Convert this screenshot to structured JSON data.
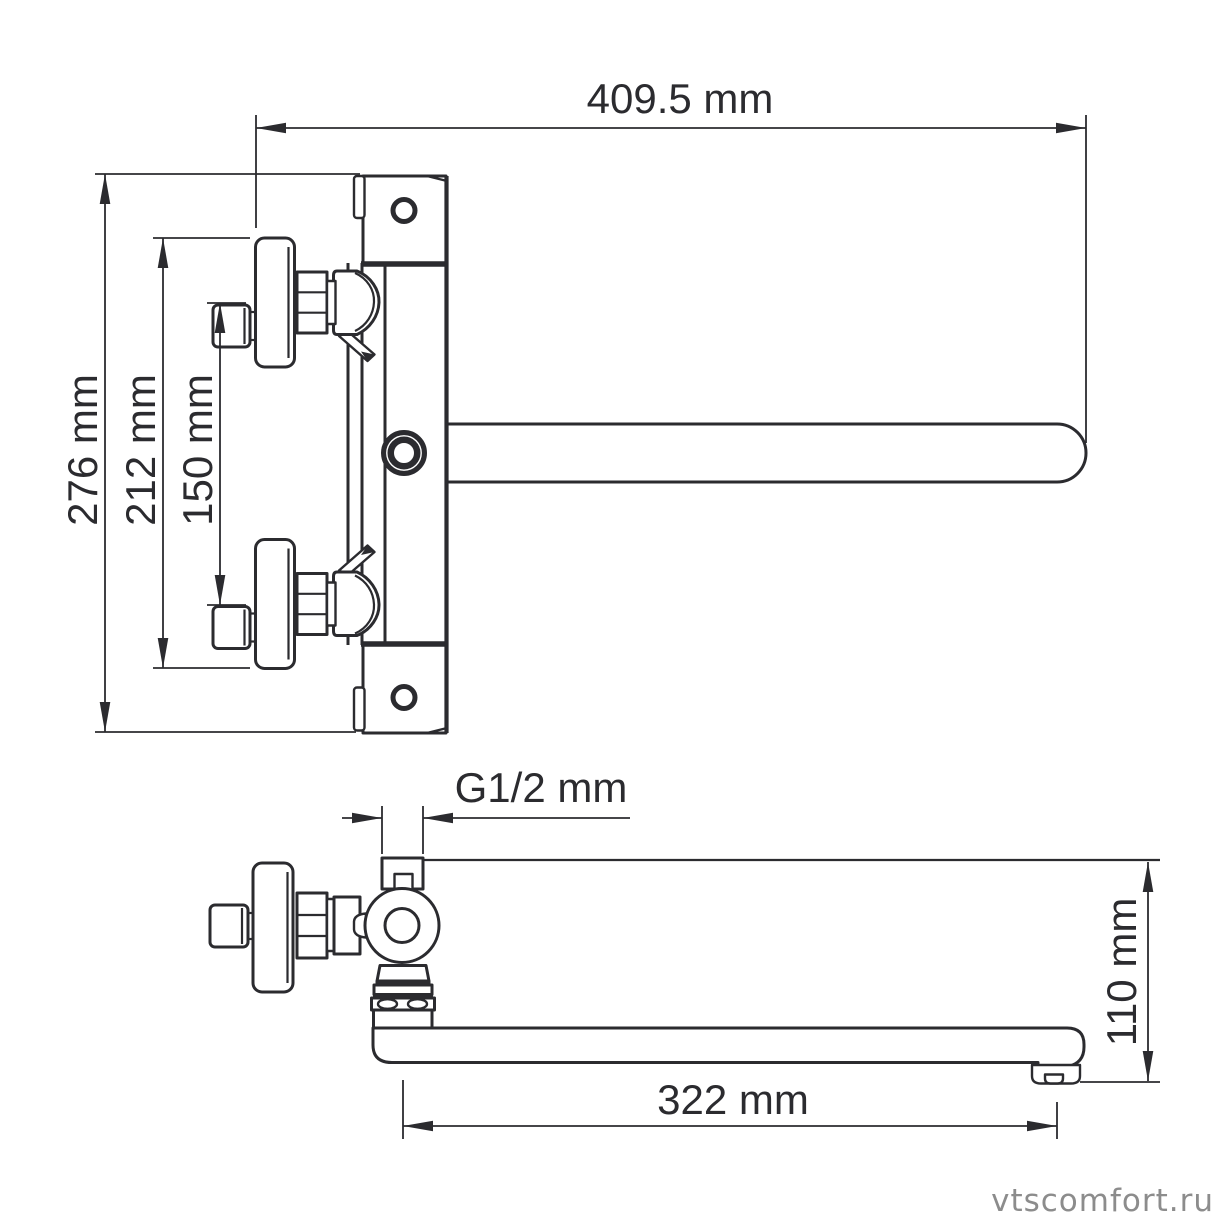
{
  "labels": {
    "width_overall": "409.5 mm",
    "height_overall": "276 mm",
    "height_body": "212 mm",
    "inlet_spacing": "150 mm",
    "thread_size": "G1/2 mm",
    "spout_length": "322 mm",
    "spout_height": "110 mm"
  },
  "watermark": "vtscomfort.ru",
  "colors": {
    "line": "#2b2b2f",
    "watermark": "#8c8c8c",
    "background": "#ffffff"
  }
}
